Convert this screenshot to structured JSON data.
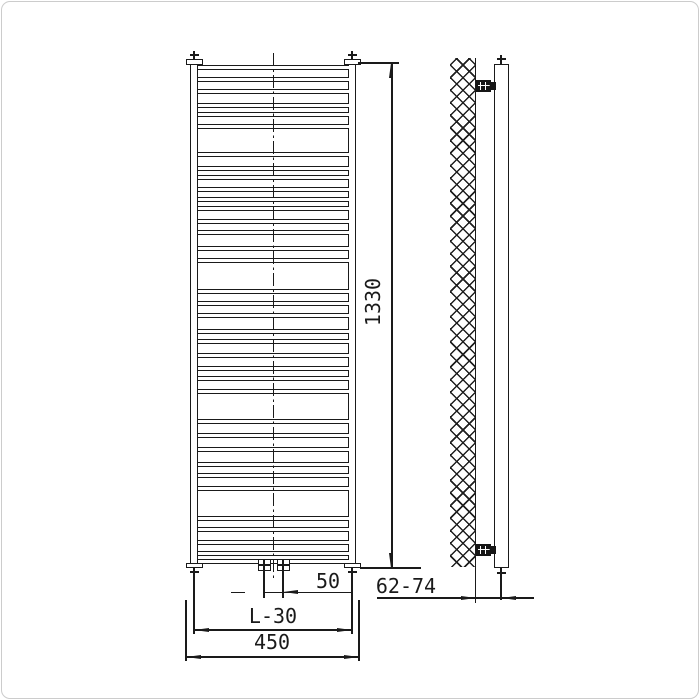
{
  "drawing": {
    "type": "technical-drawing",
    "subject": "ladder towel radiator - front elevation and side elevation with wall mounting",
    "dimension_labels": {
      "overall_height": "1330",
      "valve_spacing": "50",
      "rail_center_width": "L-30",
      "overall_width": "450",
      "wall_depth_range": "62-74"
    }
  },
  "front_view": {
    "rung_ys": [
      65,
      77,
      89,
      103,
      112,
      124,
      152,
      166,
      175,
      187,
      197,
      206,
      219,
      230,
      246,
      258,
      289,
      301,
      313,
      329,
      339,
      353,
      366,
      376,
      389,
      419,
      433,
      447,
      462,
      473,
      486,
      516,
      527,
      540,
      551,
      559
    ]
  },
  "side_view": {
    "bracket_ys": [
      80,
      544
    ]
  },
  "colors": {
    "ink": "#1a1a1a",
    "frame": "#cccccc",
    "paper": "#ffffff"
  }
}
